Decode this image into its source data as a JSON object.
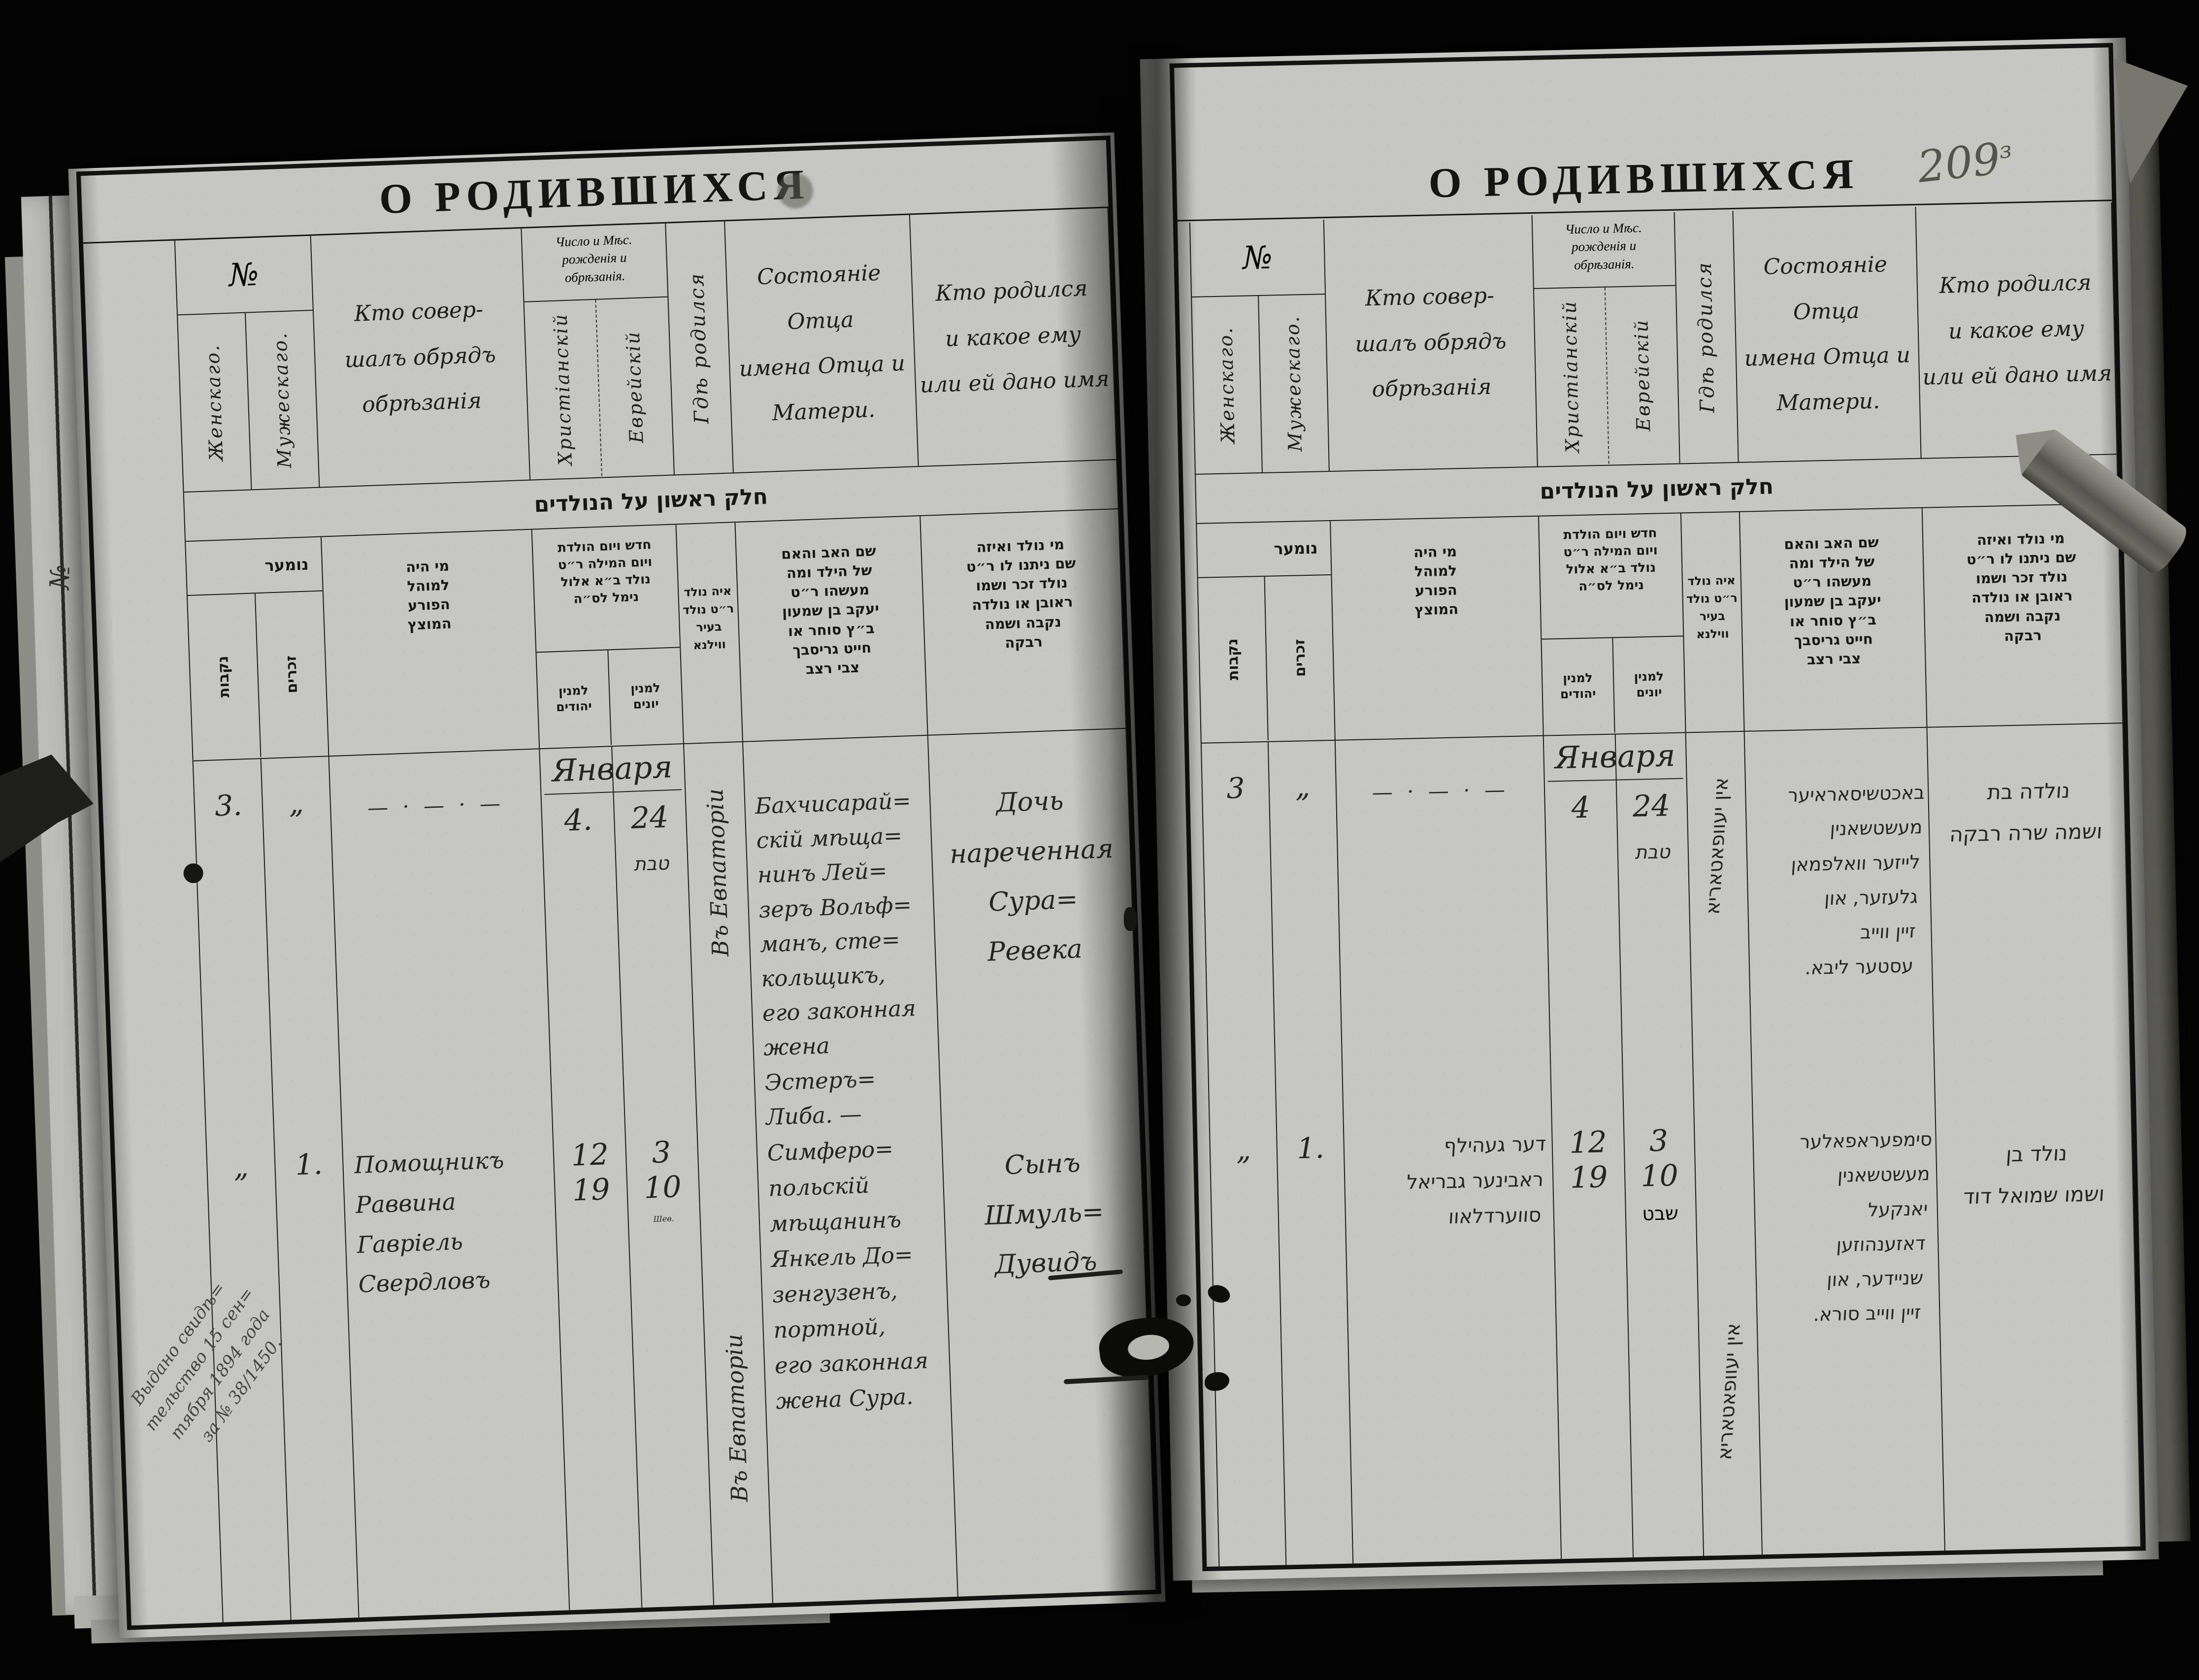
{
  "artifact": {
    "page_number": "209",
    "page_number_suffix": "з",
    "underlay_label": "№"
  },
  "headers_ru": {
    "title": "О РОДИВШИХСЯ",
    "no": "№",
    "female": "Женскаго.",
    "male": "Мужескаго.",
    "who_performed": "Кто совер-\nшалъ обрядъ\nобрѣзанія",
    "date": "Число и Мѣс.\nрожденія и\nобрѣзанія.",
    "christian": "Христіанскій",
    "jewish": "Еврейскій",
    "where_born": "Гдѣ родился",
    "parents": "Состояніе Отца\nимена Отца и\nМатери.",
    "child": "Кто родился\nи какое ему\nили ей дано имя"
  },
  "headers_he": {
    "band": "חלק ראשון על הנולדים",
    "no": "נומער",
    "female": "נקבות",
    "male": "זכרים",
    "mohel": "מי היה\nלמוהל\nהפורע\nהמוצץ",
    "date": "חדש ויום הולדת\nויום המילה ר״ט\nנולד ב״א אלול\nנימל לס״ה",
    "count_jewish": "למנין\nיהודים",
    "count_greek": "למנין\nיונים",
    "where": "איה נולד\nר״ט נולד\nבעיר\nווילנא",
    "parents": "שם האב והאם\nשל הילד ומה\nמעשהו ר״ט\nיעקב בן שמעון\nב״ץ סוחר או\nחייט גריסבך\nצבי רצב",
    "child": "מי נולד ואיזה\nשם ניתנו לו ר״ט\nנולד זכר ושמו\nראובן או נולדה\nנקבה ושמה\nרבקה"
  },
  "left_entries": {
    "r1_no_f": "3.",
    "r1_no_m": "„",
    "r1_mohel_dash": "—  ·  —  ·  —",
    "r1_month": "Января",
    "r1_day_christian": "4.",
    "r1_day_jewish": "24",
    "r1_month_jewish": "טבת",
    "r1_where": "Въ Евпаторіи",
    "r1_parents": "Бахчисарай=\nскій мѣща=\nнинъ Лей=\nзеръ Вольф=\nманъ, сте=\nкольщикъ,\nего законная\nжена Эстеръ=\nЛиба. —",
    "r1_child": "Дочь\nнареченная\nСура= Ревека",
    "r2_no_f": "„",
    "r2_no_m": "1.",
    "r2_mohel": "Помощникъ\nРаввина\nГавріель\nСвердловъ",
    "r2_day_christian": "12\n19",
    "r2_day_jewish": "3\n10",
    "r2_month_jewish": "Шев.",
    "r2_where": "Въ Евпаторіи",
    "r2_parents": "Симферо=\nпольскій\nмѣщанинъ\nЯнкель До=\nзенгузенъ,\nпортной,\nего законная\nжена Сура.",
    "r2_child": "Сынъ\nШмуль=\nДувидъ",
    "margin_note": "Выдано свидѣ=\nтельство 15 сен=\nтября 1894 года\nза № 38/1450."
  },
  "right_entries": {
    "r1_no_f": "3",
    "r1_no_m": "„",
    "r1_mohel_dash": "—  ·  —  ·  —",
    "r1_month": "Января",
    "r1_day_christian": "4",
    "r1_day_jewish": "24",
    "r1_month_jewish": "טבת",
    "r1_where": "אין יעוופאטאריא",
    "r1_parents": "באכטשיסאראיער\nמעשטשאנין\nלייזער וואלפמאן\nגלעזער, און\nזיין ווייב\nעסטער ליבא.",
    "r1_child": "נולדה בת\nושמה שרה רבקה",
    "r2_no_f": "„",
    "r2_no_m": "1.",
    "r2_mohel": "דער געהילף\nראבינער גבריאל\nסווערדלאוו",
    "r2_day_christian": "12\n19",
    "r2_day_jewish": "3\n10",
    "r2_month_jewish": "שבט",
    "r2_where": "אין יעוופאטאריא",
    "r2_parents": "סימפעראפאלער\nמעשטשאנין\nיאנקעל\nדאזענהוזען\nשניידער, און\nזיין ווייב סורא.",
    "r2_child": "נולד בן\nושמו שמואל דוד"
  }
}
